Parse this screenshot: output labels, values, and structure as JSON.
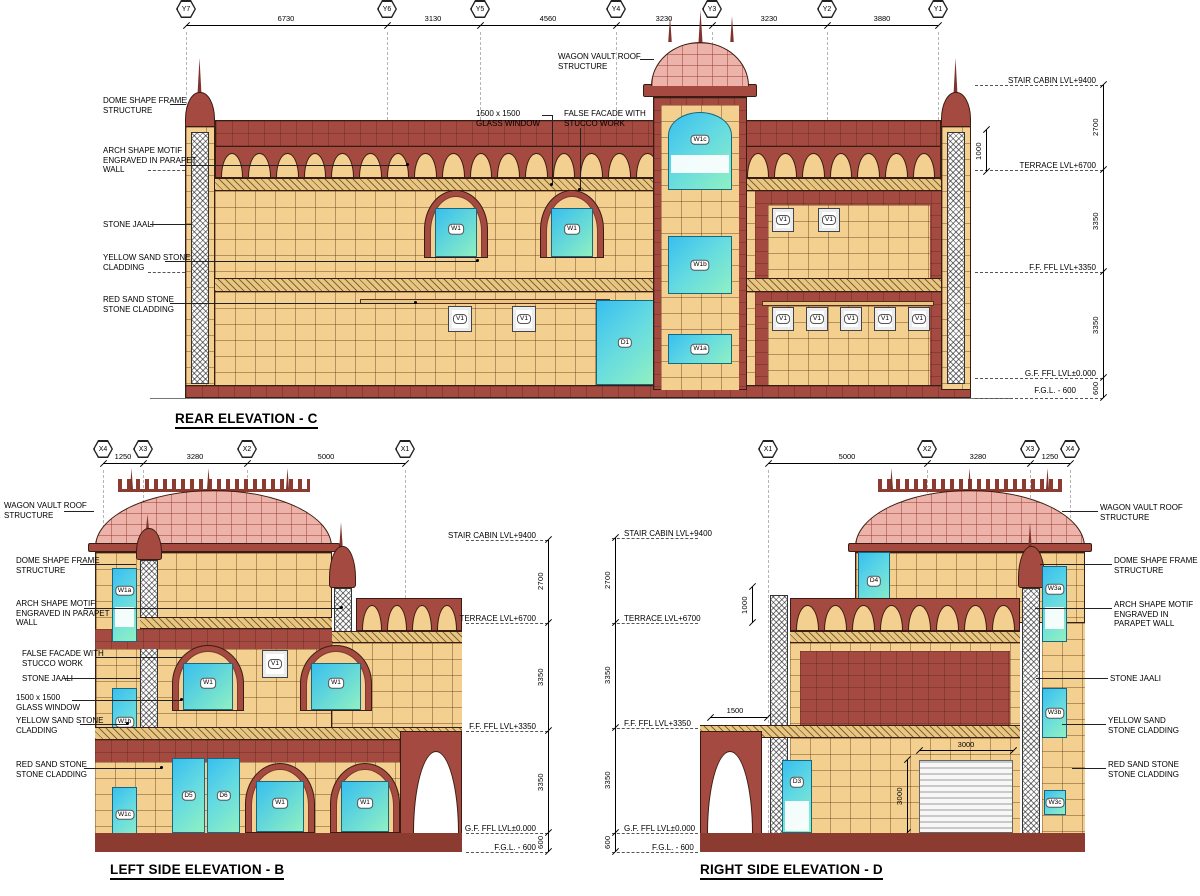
{
  "shared": {
    "levels": {
      "stair": "STAIR CABIN LVL+9400",
      "terrace": "TERRACE LVL+6700",
      "ff": "F.F. FFL LVL+3350",
      "gf": "G.F. FFL LVL±0.000",
      "fgl": "F.G.L. - 600"
    },
    "floor_dims": [
      "2700",
      "3350",
      "3350",
      "600"
    ],
    "ann": {
      "wagon": "WAGON VAULT ROOF STRUCTURE",
      "dome": "DOME SHAPE FRAME STRUCTURE",
      "arch_motif": "ARCH SHAPE MOTIF ENGRAVED IN PARAPET WALL",
      "jaali": "STONE JAALI",
      "yellow": "YELLOW SAND STONE CLADDING",
      "red": "RED SAND STONE STONE CLADDING",
      "glass_window": "1500 x 1500 GLASS WINDOW",
      "false_facade": "FALSE FACADE WITH STUCCO WORK"
    },
    "colors": {
      "yellow_sand": "#F3D08F",
      "red_sand": "#A44A40",
      "dark_red": "#8C3B31",
      "pink_roof": "#EDB2A9",
      "glass_blue": "#38BFF0",
      "glass_green": "#8FF0C2"
    }
  },
  "rear": {
    "title": "REAR ELEVATION - C",
    "grid": [
      "Y7",
      "Y6",
      "Y5",
      "Y4",
      "Y3",
      "Y2",
      "Y1"
    ],
    "grid_dims": [
      "6730",
      "3130",
      "4560",
      "3230",
      "3230",
      "3880"
    ],
    "parapet_dim": "1000",
    "tags": {
      "tower_top": "W1c",
      "tower_mid": "W1b",
      "tower_low": "W1a",
      "win": "W1",
      "vent": "V1",
      "door": "D1"
    }
  },
  "left": {
    "title": "LEFT SIDE ELEVATION - B",
    "grid": [
      "X4",
      "X3",
      "X2",
      "X1"
    ],
    "grid_dims": [
      "1250",
      "3280",
      "5000"
    ],
    "tags": {
      "edge_top": "W1a",
      "edge_mid": "W1b",
      "edge_low": "W1c",
      "win": "W1",
      "vent": "V1",
      "door1": "D5",
      "door2": "D6"
    }
  },
  "right": {
    "title": "RIGHT SIDE ELEVATION - D",
    "grid": [
      "X1",
      "X2",
      "X3",
      "X4"
    ],
    "grid_dims": [
      "5000",
      "3280",
      "1250"
    ],
    "parapet_dim": "1000",
    "porch_dim": "1500",
    "shutter_dims": [
      "3000",
      "3000"
    ],
    "tags": {
      "stair_door": "D4",
      "door": "D3",
      "edge_top": "W3a",
      "edge_mid": "W3b",
      "edge_low": "W3c"
    }
  }
}
